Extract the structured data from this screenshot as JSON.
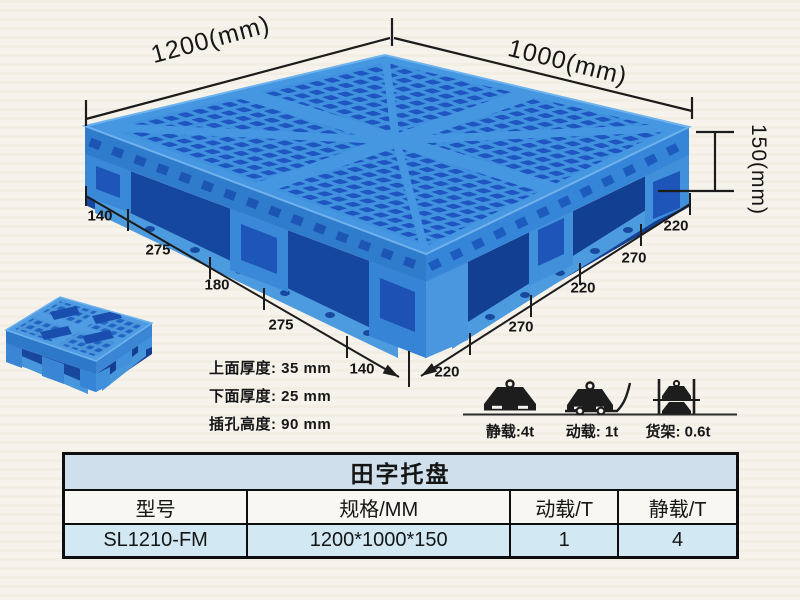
{
  "annotations": {
    "length_label": "1200(mm)",
    "width_label": "1000(mm)",
    "height_label": "150(mm)",
    "left_dims": [
      "140",
      "275",
      "180",
      "275",
      "140"
    ],
    "right_dims": [
      "220",
      "270",
      "220",
      "270",
      "220"
    ]
  },
  "specs": {
    "lines": [
      "上面厚度: 35 mm",
      "下面厚度: 25 mm",
      "插孔高度: 90 mm"
    ]
  },
  "loads": {
    "static_label": "静载:4t",
    "dynamic_label": "动载: 1t",
    "rack_label": "货架: 0.6t"
  },
  "table": {
    "title": "田字托盘",
    "headers": [
      "型号",
      "规格/MM",
      "动载/T",
      "静载/T"
    ],
    "row": [
      "SL1210-FM",
      "1200*1000*150",
      "1",
      "4"
    ]
  },
  "colors": {
    "pallet_rib_blue": "#4697e2",
    "pallet_hole_blue": "#1e55c0",
    "pallet_side_blue": "#2f7ccd",
    "table_title_bg": "#cfe0ec",
    "table_row_bg": "#d2e9f4",
    "line_color": "#1c1c1c"
  }
}
